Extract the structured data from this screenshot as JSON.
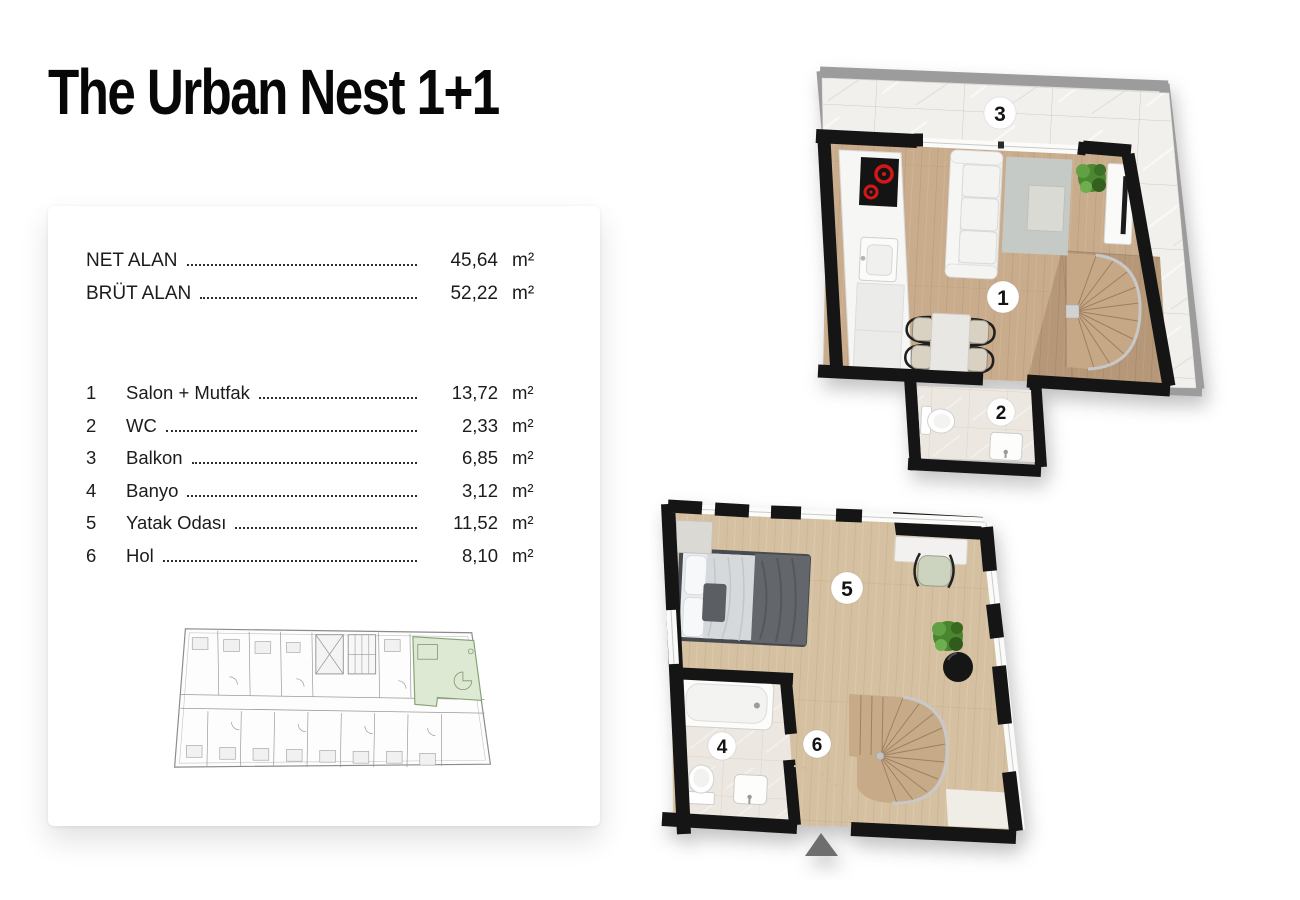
{
  "title": "The Urban Nest 1+1",
  "card": {
    "summary": [
      {
        "label": "NET ALAN",
        "value": "45,64",
        "unit": "m²"
      },
      {
        "label": "BRÜT ALAN",
        "value": "52,22",
        "unit": "m²"
      }
    ],
    "rooms": [
      {
        "num": "1",
        "label": "Salon + Mutfak",
        "value": "13,72",
        "unit": "m²"
      },
      {
        "num": "2",
        "label": "WC",
        "value": "2,33",
        "unit": "m²"
      },
      {
        "num": "3",
        "label": "Balkon",
        "value": "6,85",
        "unit": "m²"
      },
      {
        "num": "4",
        "label": "Banyo",
        "value": "3,12",
        "unit": "m²"
      },
      {
        "num": "5",
        "label": "Yatak Odası",
        "value": "11,52",
        "unit": "m²"
      },
      {
        "num": "6",
        "label": "Hol",
        "value": "8,10",
        "unit": "m²"
      }
    ]
  },
  "colors": {
    "wall": "#151515",
    "wood_living": "#c9ac8c",
    "wood_bedroom": "#d5c1a1",
    "wood_stairs": "#b69879",
    "balcony_marble": "#f2f0ed",
    "bath_tile": "#ece7e0",
    "keyplan_highlight": "#dde9d2",
    "marker_bg": "#ffffff",
    "entrance_arrow": "#6e6e6e",
    "cooktop_burner": "#d31717"
  }
}
